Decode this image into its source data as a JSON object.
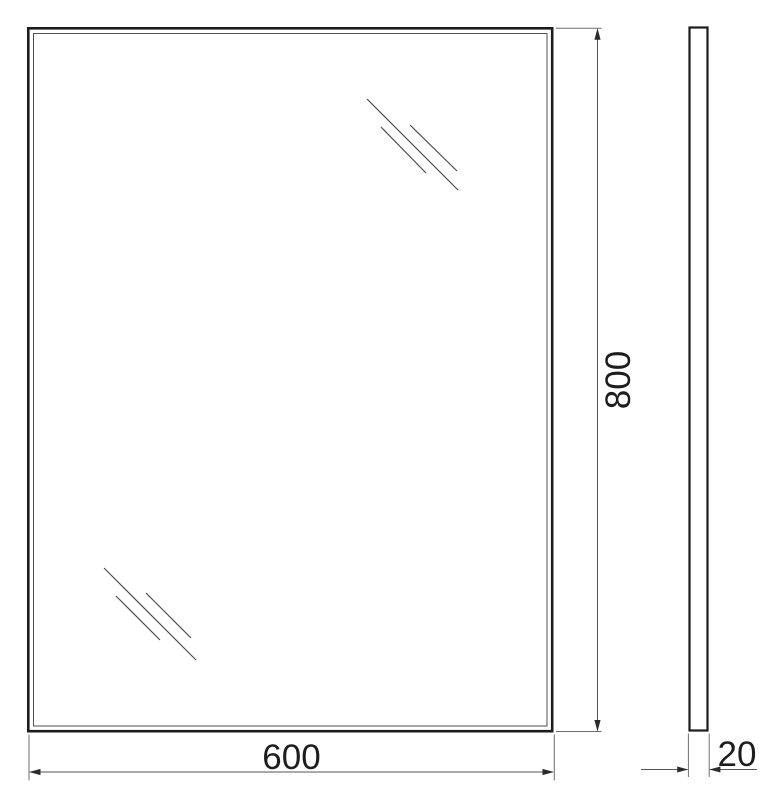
{
  "drawing": {
    "kind": "technical-drawing",
    "subject": "mirror",
    "labels": {
      "width": "600",
      "height": "800",
      "depth": "20"
    },
    "views": {
      "front": {
        "width_label": "600",
        "height_label": "800",
        "frame": "double-line outline",
        "reflection_marks": "two groups of three diagonal 45-degree lines (top-right, bottom-left)"
      },
      "side": {
        "depth_label": "20"
      }
    },
    "colors": {
      "background": "#ffffff",
      "outline_dark": "#1c1c1c",
      "line_medium": "#4f4f4f",
      "extension_line": "#6e6e6e",
      "arrow": "#2b2b2b",
      "text": "#1d1d1d"
    }
  }
}
